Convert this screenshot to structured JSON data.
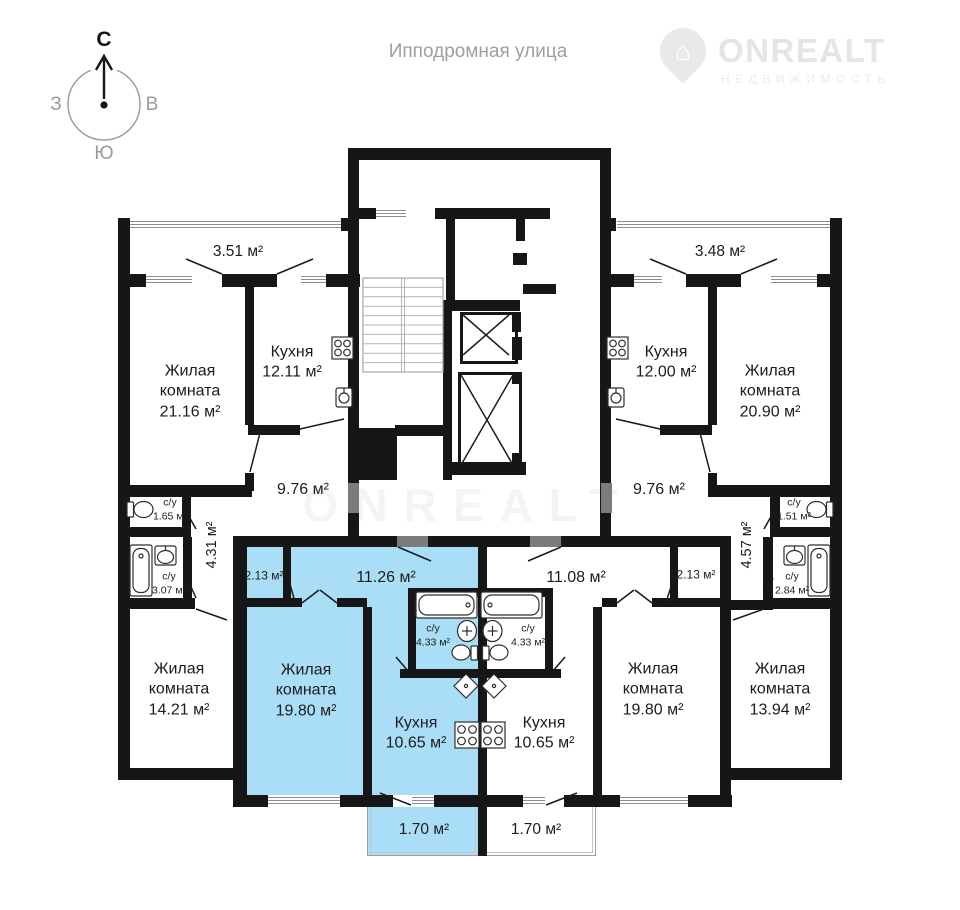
{
  "street": "Ипподромная улица",
  "compass": {
    "n": "С",
    "w": "З",
    "e": "В",
    "s": "Ю"
  },
  "logo": {
    "brand": "ONREALT",
    "tagline": "НЕДВИЖИМОСТЬ"
  },
  "watermark": "ONREALT",
  "plan": {
    "colors": {
      "highlight": "#aadef7",
      "wall": "#161616",
      "entry_door": "#7b7b7b"
    },
    "apartment_left": {
      "balcony_area": "3.51 м²",
      "living_name": "Жилая комната",
      "living_area": "21.16 м²",
      "kitchen_name": "Кухня",
      "kitchen_area": "12.11 м²",
      "hall_area": "9.76 м²",
      "wc_small_name": "с/у",
      "wc_small_area": "1.65 м²",
      "wc_big_name": "с/у",
      "wc_big_area": "3.07 м²",
      "corridor_area": "4.31 м²",
      "bedroom_name": "Жилая комната",
      "bedroom_area": "14.21 м²"
    },
    "apartment_blue": {
      "closet_area": "2.13 м²",
      "hall_area": "11.26 м²",
      "living_name": "Жилая комната",
      "living_area": "19.80 м²",
      "wc_name": "с/у",
      "wc_area": "4.33 м²",
      "kitchen_name": "Кухня",
      "kitchen_area": "10.65 м²",
      "balcony_area": "1.70 м²"
    },
    "apartment_center_right": {
      "closet_area": "2.13 м²",
      "hall_area": "11.08 м²",
      "living_name": "Жилая комната",
      "living_area": "19.80 м²",
      "wc_name": "с/у",
      "wc_area": "4.33 м²",
      "kitchen_name": "Кухня",
      "kitchen_area": "10.65 м²",
      "balcony_area": "1.70 м²"
    },
    "apartment_right": {
      "balcony_area": "3.48 м²",
      "kitchen_name": "Кухня",
      "kitchen_area": "12.00 м²",
      "living_name": "Жилая комната",
      "living_area": "20.90 м²",
      "hall_area": "9.76 м²",
      "wc_small_name": "с/у",
      "wc_small_area": "1.51 м²",
      "wc_big_name": "с/у",
      "wc_big_area": "2.84 м²",
      "corridor_area": "4.57 м²",
      "bedroom_name": "Жилая комната",
      "bedroom_area": "13.94 м²"
    }
  }
}
